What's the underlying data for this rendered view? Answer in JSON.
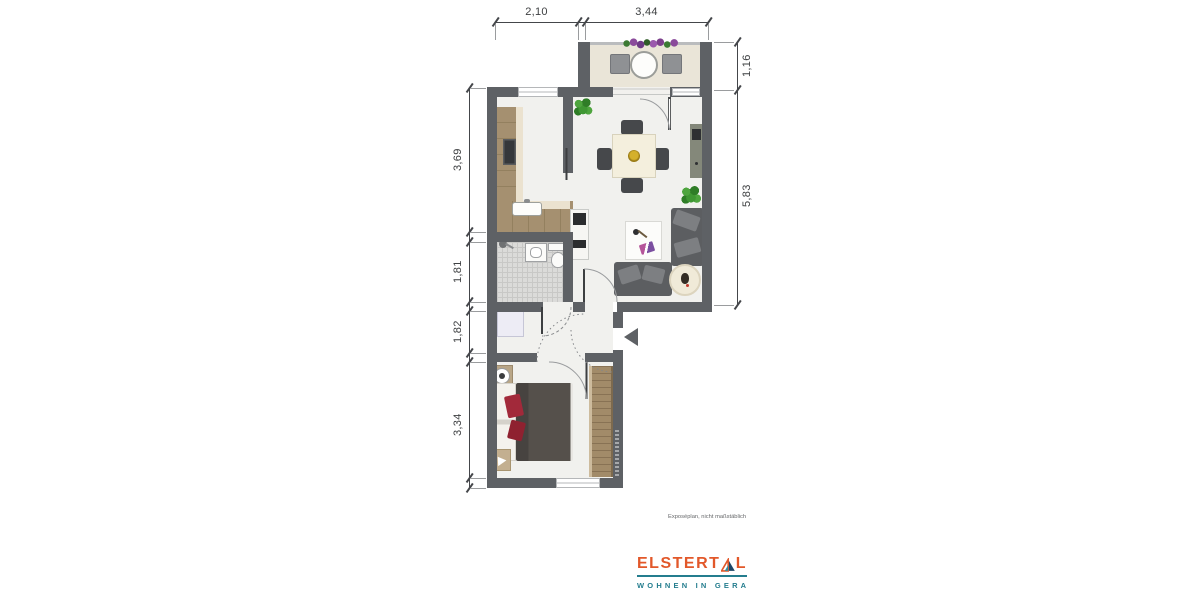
{
  "floorplan": {
    "dimensions": {
      "top": [
        "2,10",
        "3,44"
      ],
      "right": [
        "1,16",
        "5,83"
      ],
      "left": [
        "3,69",
        "1,81",
        "1,82",
        "3,34"
      ]
    },
    "note": "Exposéplan, nicht maßstäblich"
  },
  "branding": {
    "brand_part1": "ELSTERT",
    "brand_part2": "L",
    "tagline": "WOHNEN IN GERA",
    "colors": {
      "orange": "#e2582a",
      "teal": "#247d8e",
      "navy": "#1c4566"
    }
  }
}
